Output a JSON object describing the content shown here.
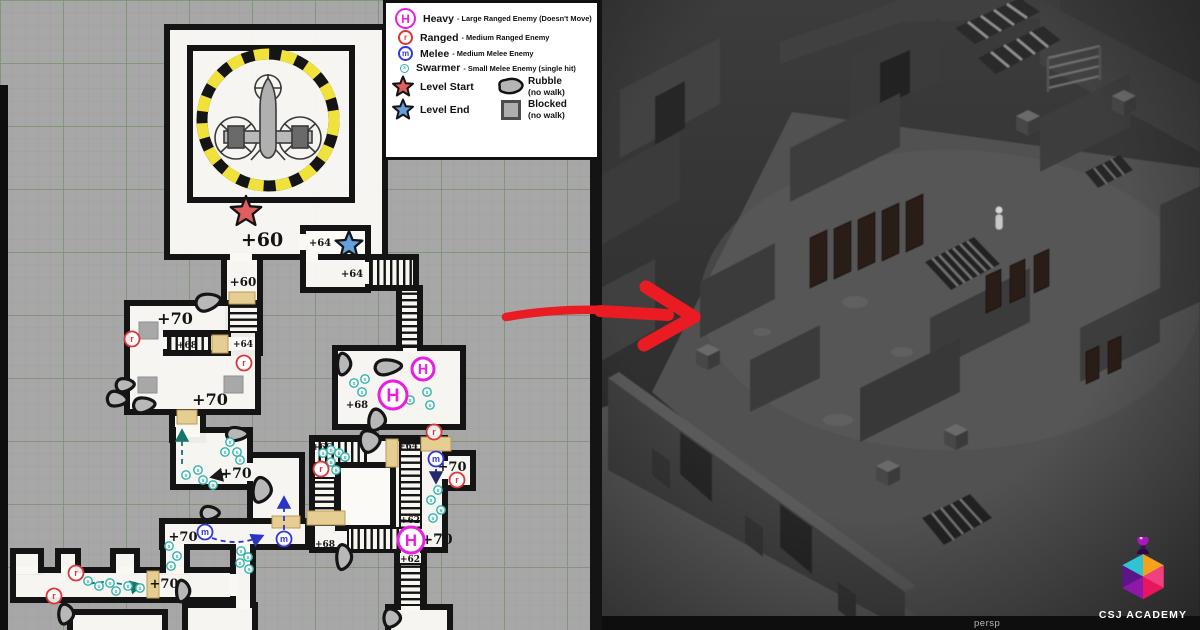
{
  "legend": {
    "rows": [
      {
        "key": "H",
        "label": "Heavy",
        "desc": "- Large Ranged Enemy (Doesn't Move)",
        "type": "heavy"
      },
      {
        "key": "r",
        "label": "Ranged",
        "desc": "- Medium Ranged Enemy",
        "type": "ranged"
      },
      {
        "key": "m",
        "label": "Melee",
        "desc": "- Medium Melee Enemy",
        "type": "melee"
      },
      {
        "key": "s",
        "label": "Swarmer",
        "desc": "- Small Melee Enemy (single hit)",
        "type": "swarmer"
      }
    ],
    "start_label": "Level Start",
    "end_label": "Level End",
    "rubble_label": "Rubble",
    "rubble_sub": "(no walk)",
    "blocked_label": "Blocked",
    "blocked_sub": "(no walk)"
  },
  "colors": {
    "heavy": "#e81ee0",
    "ranged": "#d93838",
    "melee": "#3038d8",
    "swarmer": "#2fb3ab",
    "start": "#e05e5e",
    "end": "#64a0dc",
    "door": "#e6ce92",
    "arrow": "#ea1b22"
  },
  "map": {
    "labels": [
      {
        "t": "+60",
        "x": 262,
        "y": 246,
        "s": 19
      },
      {
        "t": "+64",
        "x": 320,
        "y": 246,
        "s": 10
      },
      {
        "t": "+64",
        "x": 352,
        "y": 277,
        "s": 10
      },
      {
        "t": "+60",
        "x": 243,
        "y": 286,
        "s": 12
      },
      {
        "t": "+70",
        "x": 175,
        "y": 324,
        "s": 16
      },
      {
        "t": "+68",
        "x": 187,
        "y": 348,
        "s": 9
      },
      {
        "t": "+64",
        "x": 243,
        "y": 347,
        "s": 9
      },
      {
        "t": "+70",
        "x": 210,
        "y": 405,
        "s": 16
      },
      {
        "t": "+68",
        "x": 357,
        "y": 408,
        "s": 10
      },
      {
        "t": "+66",
        "x": 322,
        "y": 450,
        "s": 9
      },
      {
        "t": "+64",
        "x": 408,
        "y": 449,
        "s": 9
      },
      {
        "t": "+70",
        "x": 236,
        "y": 478,
        "s": 14
      },
      {
        "t": "+70",
        "x": 452,
        "y": 471,
        "s": 13
      },
      {
        "t": "+62",
        "x": 410,
        "y": 523,
        "s": 9
      },
      {
        "t": "+68",
        "x": 325,
        "y": 547,
        "s": 9
      },
      {
        "t": "+70",
        "x": 437,
        "y": 544,
        "s": 14
      },
      {
        "t": "+62",
        "x": 410,
        "y": 562,
        "s": 9
      },
      {
        "t": "+70",
        "x": 183,
        "y": 541,
        "s": 13
      },
      {
        "t": "+70",
        "x": 164,
        "y": 588,
        "s": 13
      }
    ],
    "heavies": [
      {
        "x": 393,
        "y": 395,
        "r": 14
      },
      {
        "x": 423,
        "y": 369,
        "r": 11
      },
      {
        "x": 411,
        "y": 540,
        "r": 13
      }
    ],
    "ranged": [
      [
        132,
        339
      ],
      [
        244,
        363
      ],
      [
        434,
        432
      ],
      [
        457,
        480
      ],
      [
        321,
        469
      ],
      [
        76,
        573
      ],
      [
        54,
        596
      ]
    ],
    "melee": [
      [
        205,
        532
      ],
      [
        284,
        539
      ],
      [
        436,
        459
      ]
    ],
    "swarmers": [
      [
        354,
        383
      ],
      [
        365,
        379
      ],
      [
        362,
        392
      ],
      [
        410,
        400
      ],
      [
        427,
        392
      ],
      [
        430,
        405
      ],
      [
        323,
        453
      ],
      [
        331,
        450
      ],
      [
        339,
        453
      ],
      [
        345,
        457
      ],
      [
        331,
        462
      ],
      [
        336,
        470
      ],
      [
        438,
        490
      ],
      [
        431,
        500
      ],
      [
        441,
        510
      ],
      [
        433,
        518
      ],
      [
        230,
        442
      ],
      [
        225,
        452
      ],
      [
        237,
        452
      ],
      [
        240,
        460
      ],
      [
        198,
        470
      ],
      [
        186,
        475
      ],
      [
        203,
        480
      ],
      [
        213,
        485
      ],
      [
        241,
        551
      ],
      [
        248,
        557
      ],
      [
        240,
        563
      ],
      [
        249,
        569
      ],
      [
        169,
        546
      ],
      [
        177,
        556
      ],
      [
        171,
        566
      ],
      [
        88,
        581
      ],
      [
        99,
        586
      ],
      [
        110,
        583
      ],
      [
        116,
        591
      ],
      [
        128,
        586
      ],
      [
        140,
        588
      ]
    ],
    "stars": {
      "start": {
        "x": 246,
        "y": 212,
        "r": 16
      },
      "end": {
        "x": 349,
        "y": 245,
        "r": 14
      }
    },
    "doors": [
      [
        229,
        292,
        26,
        12
      ],
      [
        212,
        335,
        16,
        18
      ],
      [
        177,
        410,
        20,
        14
      ],
      [
        147,
        571,
        12,
        27
      ],
      [
        272,
        516,
        28,
        12
      ],
      [
        307,
        511,
        38,
        14
      ],
      [
        421,
        437,
        30,
        14
      ],
      [
        386,
        439,
        12,
        28
      ]
    ],
    "blocked": [
      [
        139,
        322,
        19,
        17
      ],
      [
        138,
        377,
        19,
        16
      ],
      [
        224,
        376,
        19,
        17
      ]
    ],
    "rubble": [
      [
        208,
        302,
        30,
        20,
        -12
      ],
      [
        125,
        385,
        22,
        16,
        -5
      ],
      [
        117,
        399,
        24,
        18,
        8
      ],
      [
        144,
        405,
        26,
        18,
        -6
      ],
      [
        344,
        364,
        16,
        26,
        0
      ],
      [
        388,
        367,
        32,
        18,
        -5
      ],
      [
        377,
        420,
        20,
        26,
        8
      ],
      [
        370,
        441,
        24,
        26,
        -10
      ],
      [
        237,
        434,
        26,
        16,
        0
      ],
      [
        262,
        490,
        22,
        30,
        5
      ],
      [
        210,
        513,
        22,
        16,
        0
      ],
      [
        344,
        557,
        18,
        30,
        0
      ],
      [
        392,
        618,
        20,
        22,
        0
      ],
      [
        66,
        614,
        18,
        24,
        0
      ],
      [
        183,
        591,
        16,
        26,
        0
      ]
    ],
    "paths": [
      {
        "d": "M182,464 L182,431",
        "c": "teal"
      },
      {
        "d": "M90,584 C108,578 128,588 141,585",
        "c": "teal"
      },
      {
        "d": "M226,474 L212,477",
        "c": "black"
      },
      {
        "d": "M212,538 Q238,547 262,536",
        "c": "blue"
      },
      {
        "d": "M284,530 L284,498",
        "c": "blue"
      },
      {
        "d": "M436,469 L436,482",
        "c": "navy"
      }
    ]
  },
  "viewport": {
    "camera_label": "persp"
  },
  "brand": {
    "name": "CSJ ACADEMY"
  }
}
